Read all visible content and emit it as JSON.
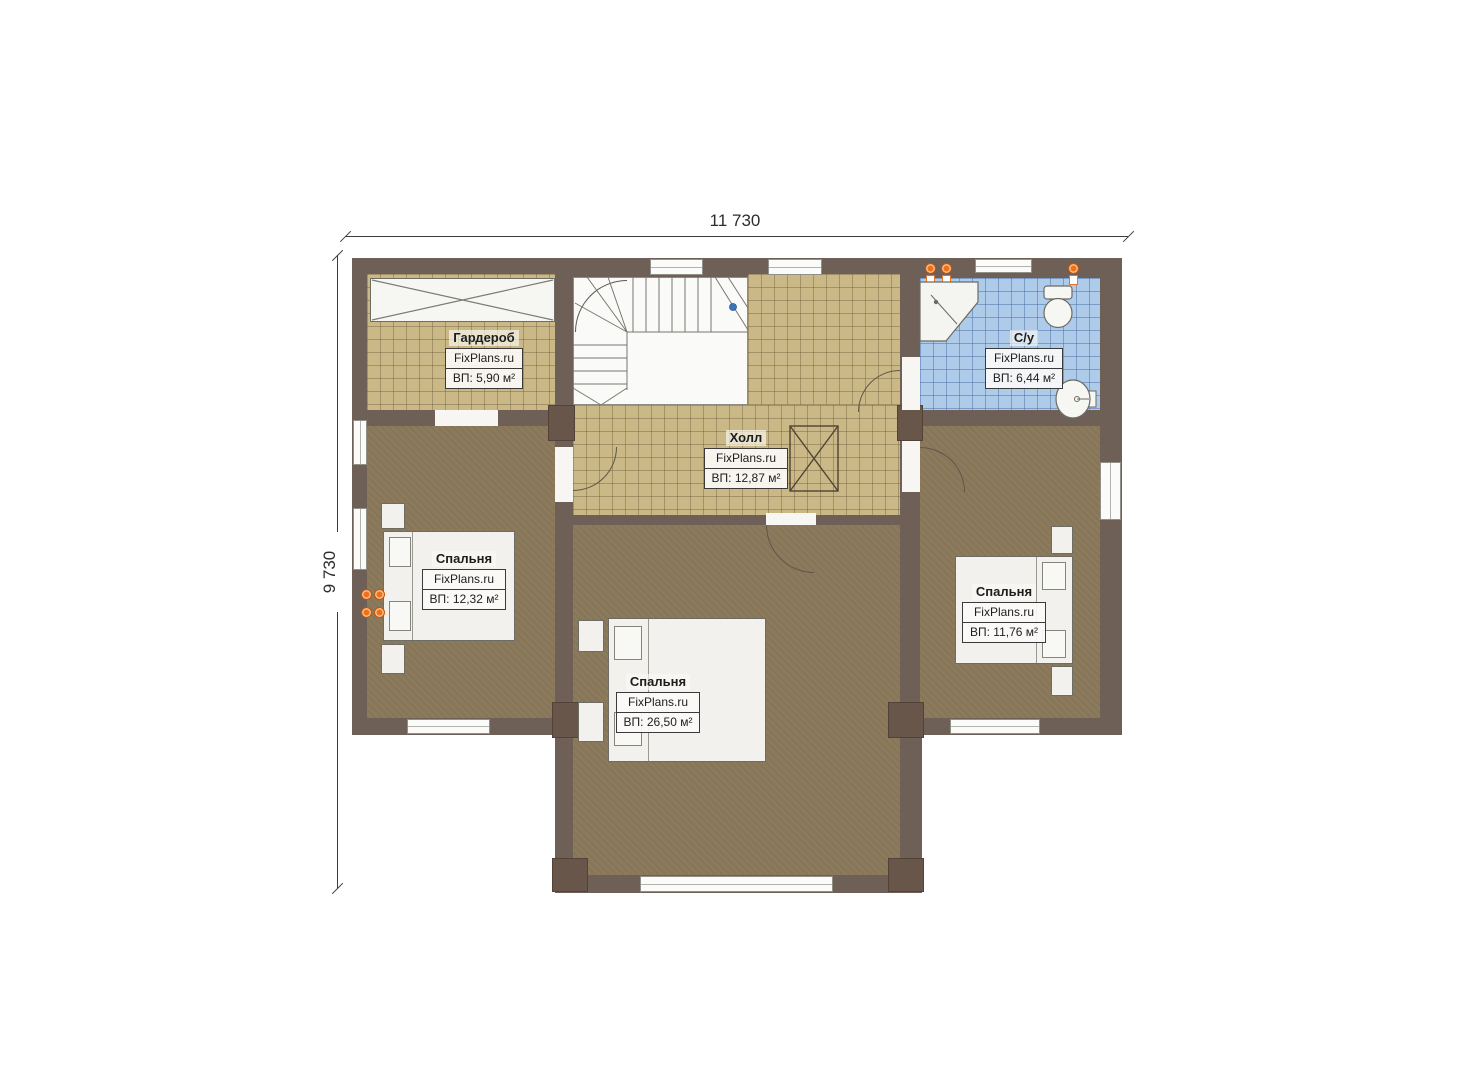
{
  "dimensions": {
    "width_label": "11 730",
    "height_label": "9 730"
  },
  "brand": {
    "watermark": "FixPlans.ru"
  },
  "rooms": {
    "wardrobe": {
      "name": "Гардероб",
      "area": "ВП: 5,90 м²"
    },
    "hall": {
      "name": "Холл",
      "area": "ВП: 12,87 м²"
    },
    "bathroom": {
      "name": "С/у",
      "area": "ВП: 6,44 м²"
    },
    "bedroom_left": {
      "name": "Спальня",
      "area": "ВП: 12,32 м²"
    },
    "bedroom_center": {
      "name": "Спальня",
      "area": "ВП: 26,50 м²"
    },
    "bedroom_right": {
      "name": "Спальня",
      "area": "ВП: 11,76 м²"
    }
  },
  "fixtures": [
    "staircase",
    "corner-shower",
    "toilet",
    "sink",
    "radiator",
    "bed",
    "wardrobe-closet",
    "shaft"
  ],
  "colors": {
    "wall": "#6f6057",
    "tile_tan": "#cab986",
    "tile_blue": "#aecbe9",
    "carpet": "#8c7a5c",
    "radiator_orange": "#ed7117",
    "handrail_dot_blue": "#3f74b8"
  }
}
